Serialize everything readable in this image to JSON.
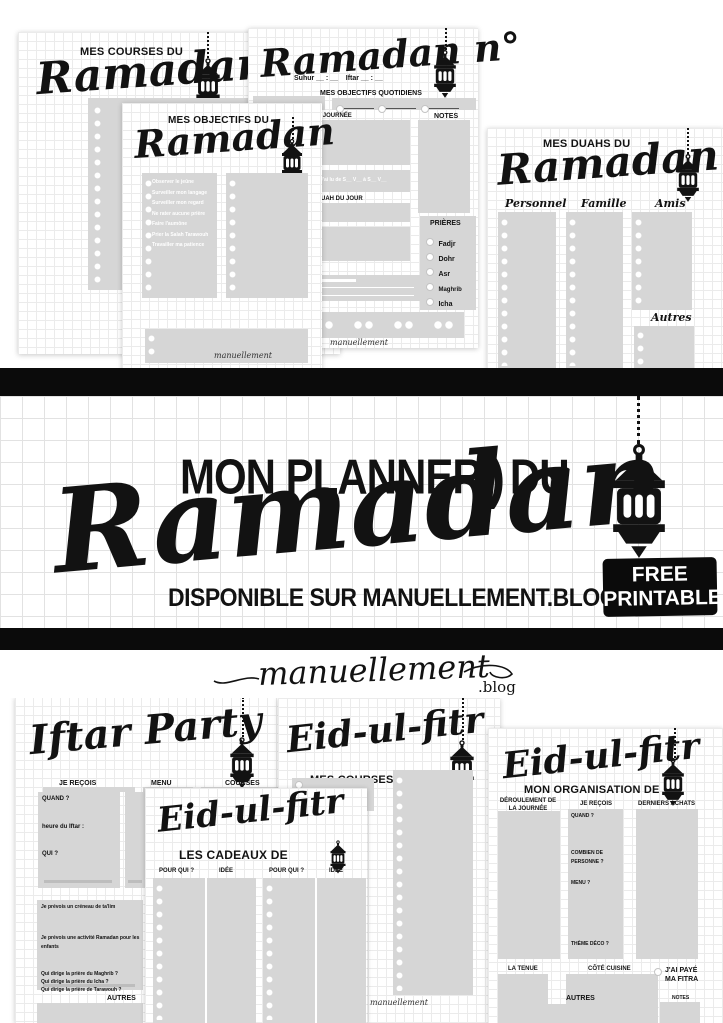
{
  "poster": {
    "banner": {
      "kicker": "MON PLANNER",
      "divider": ")",
      "kicker2": "DU",
      "title": "Ramadan",
      "availability": "DISPONIBLE SUR MANUELLEMENT.BLOG",
      "badge": [
        "FREE",
        "PRINTABLE"
      ]
    },
    "logo": {
      "script": "manuellement",
      "suffix": ".blog"
    },
    "signature": "manuellement"
  },
  "pages": {
    "courses": {
      "eyebrow": "MES COURSES DU",
      "title": "Ramadan"
    },
    "objectifs": {
      "eyebrow": "MES OBJECTIFS DU",
      "title": "Ramadan",
      "items": [
        "Observer le jeûne",
        "Surveiller mon langage",
        "Surveiller mon regard",
        "Ne rater aucune prière",
        "Faire l'aumône",
        "Prier la Salah Tarawouh",
        "Travailler ma patience"
      ]
    },
    "ramadan_n": {
      "title": "Ramadan n°",
      "suhur": "Suhur __ : __",
      "iftar": "Iftar __ : __",
      "fasted": "J'ai jeûné",
      "daily_objectives": "MES OBJECTIFS QUOTIDIENS",
      "day": "MA JOURNÉE",
      "notes": "NOTES",
      "coran": "J'ai lu de S__ V__ à S__ V__",
      "doua": "DOUAH DU JOUR",
      "prayers_title": "PRIÈRES",
      "prayers": [
        "Fadjr",
        "Dohr",
        "Asr",
        "Maghrib",
        "Icha"
      ]
    },
    "duahs": {
      "eyebrow": "MES DUAHS DU",
      "title": "Ramadan",
      "columns": [
        "Personnel",
        "Famille",
        "Amis",
        "Autres"
      ]
    },
    "iftar": {
      "title": "Iftar Party",
      "headers": [
        "JE REÇOIS",
        "MENU",
        "COURSES"
      ],
      "fields": [
        "QUAND ?",
        "heure du Iftar :",
        "QUI ?"
      ],
      "planning": [
        "Je prévois un créneau de ta'lim",
        "Je prévois une activité Ramadan pour les enfants"
      ],
      "questions": [
        "Qui dirige la prière du Maghrib ?",
        "Qui dirige la prière du Icha ?",
        "Qui dirige la prière de Tarawouh ?"
      ],
      "autres": "AUTRES"
    },
    "eid_courses": {
      "title": "Eid-ul-fitr",
      "subtitle": "MES COURSES DE"
    },
    "eid_cadeaux": {
      "title": "Eid-ul-fitr",
      "subtitle": "LES CADEAUX DE",
      "headers": [
        "POUR QUI ?",
        "IDÉE",
        "POUR QUI ?",
        "IDÉE"
      ]
    },
    "eid_orga": {
      "title": "Eid-ul-fitr",
      "subtitle": "MON ORGANISATION DE",
      "col1": "DÉROULEMENT DE LA JOURNÉE",
      "col2": "JE REÇOIS",
      "col2_fields": [
        "QUAND ?",
        "COMBIEN DE PERSONNE ?",
        "MENU ?",
        "THÈME DÉCO ?"
      ],
      "col3": "DERNIERS ACHATS",
      "tenue": "LA TENUE",
      "cuisine": "CÔTÉ CUISINE",
      "fitra": "J'AI PAYÉ MA FITRA",
      "notes": "NOTES",
      "autres": "AUTRES"
    }
  },
  "colors": {
    "ink": "#121212",
    "panel": "#d6d6d6",
    "grid": "#ebebeb",
    "paper": "#ffffff",
    "bar": "#0b0b0b"
  }
}
